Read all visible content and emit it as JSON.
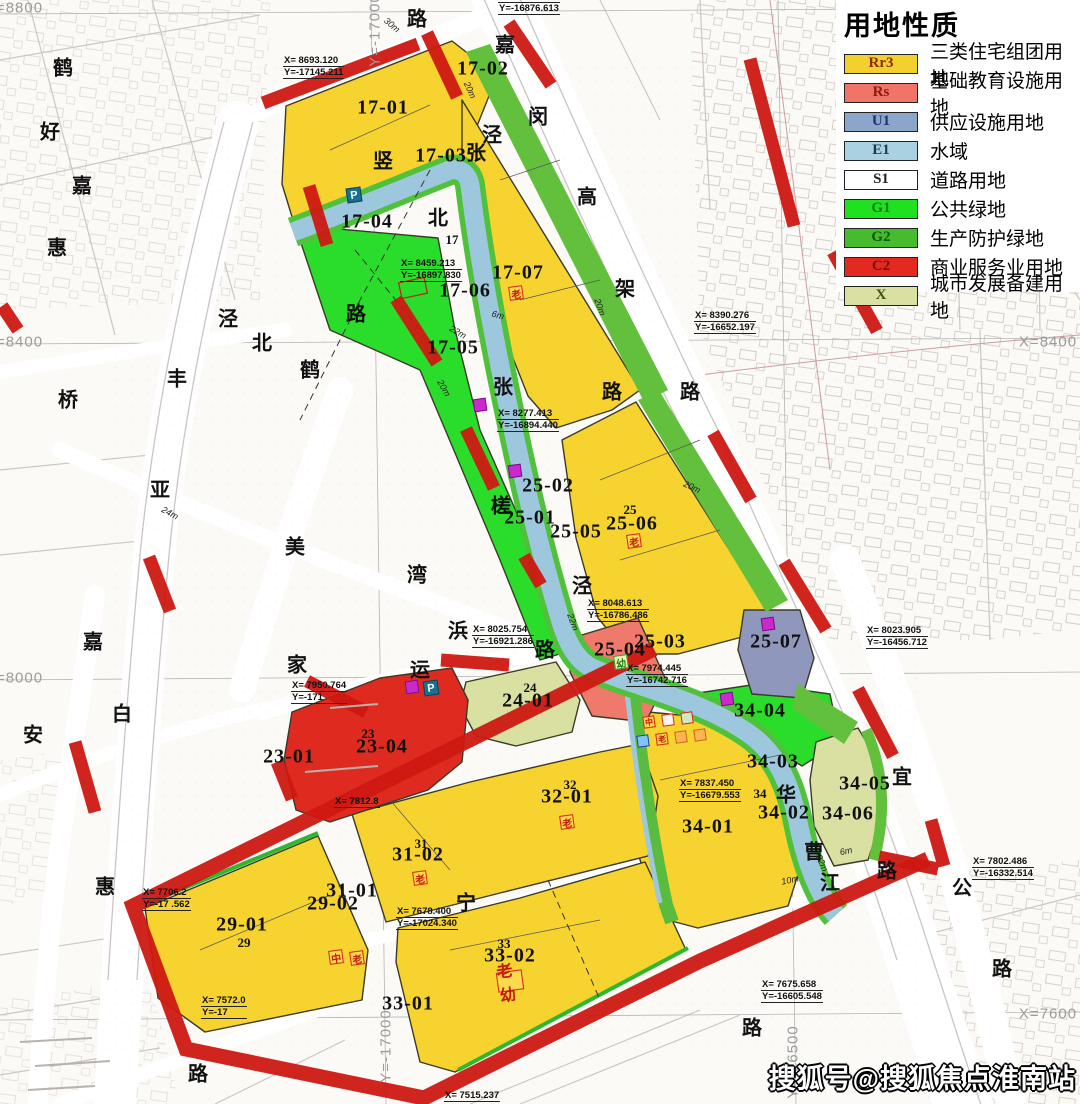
{
  "page": {
    "width": 1080,
    "height": 1104
  },
  "legend": {
    "title": "用地性质",
    "items": [
      {
        "code": "Rr3",
        "label": "三类住宅组团用地",
        "color": "#F2D12E",
        "code_color": "#8a2a00"
      },
      {
        "code": "Rs",
        "label": "基础教育设施用地",
        "color": "#F07467",
        "code_color": "#8b1a10"
      },
      {
        "code": "U1",
        "label": "供应设施用地",
        "color": "#8CA6CB",
        "code_color": "#20306b"
      },
      {
        "code": "E1",
        "label": "水域",
        "color": "#A9D1E2",
        "code_color": "#1a3a4a"
      },
      {
        "code": "S1",
        "label": "道路用地",
        "color": "#FFFFFF",
        "code_color": "#222222"
      },
      {
        "code": "G1",
        "label": "公共绿地",
        "color": "#1FE11F",
        "code_color": "#0a7a0a"
      },
      {
        "code": "G2",
        "label": "生产防护绿地",
        "color": "#45BB2D",
        "code_color": "#0b5a0b"
      },
      {
        "code": "C2",
        "label": "商业服务业用地",
        "color": "#E42A20",
        "code_color": "#7a0d08"
      },
      {
        "code": "X",
        "label": "城市发展备建用地",
        "color": "#D9E0A2",
        "code_color": "#3f5210"
      }
    ]
  },
  "watermark": {
    "text": "搜狐号@搜狐焦点淮南站"
  },
  "colors": {
    "residential_yellow": "#F6D32F",
    "education_salmon": "#EF796B",
    "utility_blue": "#9097BC",
    "water_blue": "#9CC7DD",
    "green_public": "#2ADD2A",
    "green_buffer": "#63C03C",
    "commercial_red": "#DF2B1F",
    "reserve_green": "#D9E0A2",
    "road_red": "#CE1812"
  },
  "map": {
    "parcel_labels": [
      {
        "t": "17-01",
        "x": 383,
        "y": 108
      },
      {
        "t": "17-02",
        "x": 483,
        "y": 69
      },
      {
        "t": "17-03",
        "x": 441,
        "y": 156
      },
      {
        "t": "17-04",
        "x": 367,
        "y": 222
      },
      {
        "t": "17-05",
        "x": 453,
        "y": 348
      },
      {
        "t": "17-06",
        "x": 465,
        "y": 291
      },
      {
        "t": "17-07",
        "x": 518,
        "y": 273
      },
      {
        "t": "25-01",
        "x": 530,
        "y": 518
      },
      {
        "t": "25-02",
        "x": 548,
        "y": 486
      },
      {
        "t": "25-05",
        "x": 576,
        "y": 532
      },
      {
        "t": "25-06",
        "x": 632,
        "y": 524
      },
      {
        "t": "25-03",
        "x": 660,
        "y": 642
      },
      {
        "t": "25-04",
        "x": 620,
        "y": 650
      },
      {
        "t": "25-07",
        "x": 776,
        "y": 642
      },
      {
        "t": "24-01",
        "x": 528,
        "y": 701
      },
      {
        "t": "23-04",
        "x": 382,
        "y": 747
      },
      {
        "t": "23-01",
        "x": 289,
        "y": 757
      },
      {
        "t": "29-01",
        "x": 242,
        "y": 925
      },
      {
        "t": "29-02",
        "x": 333,
        "y": 904
      },
      {
        "t": "31-01",
        "x": 352,
        "y": 891
      },
      {
        "t": "31-02",
        "x": 418,
        "y": 855
      },
      {
        "t": "32-01",
        "x": 567,
        "y": 797
      },
      {
        "t": "33-01",
        "x": 408,
        "y": 1004
      },
      {
        "t": "33-02",
        "x": 510,
        "y": 956
      },
      {
        "t": "34-01",
        "x": 708,
        "y": 827
      },
      {
        "t": "34-02",
        "x": 784,
        "y": 813
      },
      {
        "t": "34-03",
        "x": 773,
        "y": 762
      },
      {
        "t": "34-04",
        "x": 760,
        "y": 711
      },
      {
        "t": "34-05",
        "x": 865,
        "y": 784
      },
      {
        "t": "34-06",
        "x": 848,
        "y": 814
      }
    ],
    "sub_labels": [
      {
        "t": "17",
        "x": 452,
        "y": 240
      },
      {
        "t": "25",
        "x": 630,
        "y": 510
      },
      {
        "t": "23",
        "x": 368,
        "y": 734
      },
      {
        "t": "24",
        "x": 530,
        "y": 688
      },
      {
        "t": "29",
        "x": 244,
        "y": 943
      },
      {
        "t": "31",
        "x": 421,
        "y": 844
      },
      {
        "t": "32",
        "x": 570,
        "y": 785
      },
      {
        "t": "33",
        "x": 504,
        "y": 944
      },
      {
        "t": "34",
        "x": 760,
        "y": 794
      }
    ],
    "road_chars": [
      {
        "t": "鹤",
        "x": 63,
        "y": 66
      },
      {
        "t": "好",
        "x": 50,
        "y": 130
      },
      {
        "t": "嘉",
        "x": 82,
        "y": 184
      },
      {
        "t": "惠",
        "x": 57,
        "y": 246
      },
      {
        "t": "泾",
        "x": 228,
        "y": 317
      },
      {
        "t": "北",
        "x": 262,
        "y": 341
      },
      {
        "t": "丰",
        "x": 177,
        "y": 377
      },
      {
        "t": "桥",
        "x": 68,
        "y": 398
      },
      {
        "t": "亚",
        "x": 160,
        "y": 488
      },
      {
        "t": "美",
        "x": 295,
        "y": 545
      },
      {
        "t": "湾",
        "x": 417,
        "y": 573
      },
      {
        "t": "嘉",
        "x": 93,
        "y": 640
      },
      {
        "t": "白",
        "x": 122,
        "y": 712
      },
      {
        "t": "安",
        "x": 33,
        "y": 733
      },
      {
        "t": "惠",
        "x": 105,
        "y": 885
      },
      {
        "t": "路",
        "x": 198,
        "y": 1072
      },
      {
        "t": "路",
        "x": 356,
        "y": 312
      },
      {
        "t": "鹤",
        "x": 310,
        "y": 368
      },
      {
        "t": "北",
        "x": 438,
        "y": 216
      },
      {
        "t": "竖",
        "x": 383,
        "y": 159
      },
      {
        "t": "张",
        "x": 476,
        "y": 151
      },
      {
        "t": "泾",
        "x": 492,
        "y": 133
      },
      {
        "t": "张",
        "x": 503,
        "y": 385
      },
      {
        "t": "泾",
        "x": 582,
        "y": 584
      },
      {
        "t": "槎",
        "x": 501,
        "y": 504
      },
      {
        "t": "浜",
        "x": 458,
        "y": 629
      },
      {
        "t": "家",
        "x": 297,
        "y": 663
      },
      {
        "t": "运",
        "x": 420,
        "y": 668
      },
      {
        "t": "路",
        "x": 545,
        "y": 648
      },
      {
        "t": "宁",
        "x": 466,
        "y": 901
      },
      {
        "t": "嘉",
        "x": 505,
        "y": 43
      },
      {
        "t": "闵",
        "x": 538,
        "y": 115
      },
      {
        "t": "高",
        "x": 587,
        "y": 195
      },
      {
        "t": "架",
        "x": 625,
        "y": 287
      },
      {
        "t": "路",
        "x": 690,
        "y": 390
      },
      {
        "t": "路",
        "x": 612,
        "y": 390
      },
      {
        "t": "路",
        "x": 417,
        "y": 17
      },
      {
        "t": "宜",
        "x": 902,
        "y": 775
      },
      {
        "t": "公",
        "x": 962,
        "y": 886
      },
      {
        "t": "路",
        "x": 1002,
        "y": 967
      },
      {
        "t": "路",
        "x": 887,
        "y": 869
      },
      {
        "t": "路",
        "x": 752,
        "y": 1026
      },
      {
        "t": "曹",
        "x": 814,
        "y": 850
      },
      {
        "t": "江",
        "x": 830,
        "y": 881
      },
      {
        "t": "华",
        "x": 786,
        "y": 793
      }
    ],
    "dim_labels": [
      {
        "t": "30m",
        "x": 392,
        "y": 25,
        "r": 40
      },
      {
        "t": "20m",
        "x": 470,
        "y": 90,
        "r": 65
      },
      {
        "t": "6m",
        "x": 498,
        "y": 315,
        "r": 15
      },
      {
        "t": "22m",
        "x": 458,
        "y": 332,
        "r": 30
      },
      {
        "t": "20m",
        "x": 444,
        "y": 388,
        "r": 60
      },
      {
        "t": "20m",
        "x": 600,
        "y": 307,
        "r": 70
      },
      {
        "t": "24m",
        "x": 170,
        "y": 513,
        "r": 28
      },
      {
        "t": "20m",
        "x": 692,
        "y": 487,
        "r": 25
      },
      {
        "t": "22m",
        "x": 573,
        "y": 622,
        "r": 70
      },
      {
        "t": "10m",
        "x": 790,
        "y": 880,
        "r": -12
      },
      {
        "t": "22m",
        "x": 822,
        "y": 863,
        "r": 65
      },
      {
        "t": "6m",
        "x": 846,
        "y": 851,
        "r": -12
      }
    ],
    "grid_labels": [
      {
        "t": "X=8800",
        "x": 14,
        "y": 8,
        "r": 0
      },
      {
        "t": "X=8400",
        "x": 14,
        "y": 342,
        "r": 0
      },
      {
        "t": "X=8000",
        "x": 14,
        "y": 678,
        "r": 0
      },
      {
        "t": "X=8400",
        "x": 1048,
        "y": 342,
        "r": 0
      },
      {
        "t": "X=7600",
        "x": 1048,
        "y": 1014,
        "r": 0
      },
      {
        "t": "Y=-17000",
        "x": 375,
        "y": 30,
        "r": -90
      },
      {
        "t": "Y=-17000",
        "x": 386,
        "y": 1046,
        "r": -90
      },
      {
        "t": "Y=-16500",
        "x": 793,
        "y": 1062,
        "r": -90
      }
    ],
    "callouts": [
      {
        "xl": "X= 8693.120",
        "yl": "Y=-17145.211",
        "x": 283,
        "y": 55
      },
      {
        "xl": "X= 8604.073",
        "yl": "Y=-16876.613",
        "x": 498,
        "y": -9
      },
      {
        "xl": "X= 8459.213",
        "yl": "Y=-16897.830",
        "x": 400,
        "y": 258
      },
      {
        "xl": "X= 8390.276",
        "yl": "Y=-16652.197",
        "x": 694,
        "y": 310
      },
      {
        "xl": "X= 8277.413",
        "yl": "Y=-16894.440",
        "x": 497,
        "y": 408
      },
      {
        "xl": "X= 8048.613",
        "yl": "Y=-16786.486",
        "x": 587,
        "y": 598
      },
      {
        "xl": "X= 8025.754",
        "yl": "Y=-16921.286",
        "x": 472,
        "y": 624
      },
      {
        "xl": "X= 7974.445",
        "yl": "Y=-16742.716",
        "x": 626,
        "y": 663
      },
      {
        "xl": "X= 8023.905",
        "yl": "Y=-16456.712",
        "x": 866,
        "y": 625
      },
      {
        "xl": "X= 7950.764",
        "yl": "Y=-171",
        "x": 291,
        "y": 680
      },
      {
        "xl": "X= 7837.450",
        "yl": "Y=-16679.553",
        "x": 679,
        "y": 778
      },
      {
        "xl": "X= 7812.8",
        "yl": "",
        "x": 334,
        "y": 796
      },
      {
        "xl": "X= 7678.400",
        "yl": "Y=-17024.340",
        "x": 396,
        "y": 906
      },
      {
        "xl": "X= 7706.2",
        "yl": "Y=-17  .562",
        "x": 142,
        "y": 887
      },
      {
        "xl": "X= 7675.658",
        "yl": "Y=-16605.548",
        "x": 761,
        "y": 979
      },
      {
        "xl": "X= 7802.486",
        "yl": "Y=-16332.514",
        "x": 972,
        "y": 856
      },
      {
        "xl": "X= 7572.0",
        "yl": "Y=-17",
        "x": 201,
        "y": 995
      },
      {
        "xl": "X= 7515.237",
        "yl": "",
        "x": 444,
        "y": 1090
      }
    ],
    "icons": [
      {
        "k": "parking-icon",
        "g": "P",
        "x": 354,
        "y": 195,
        "bg": "#17708e",
        "bd": "#0d4257",
        "fg": "#fff",
        "w": 15
      },
      {
        "k": "parking-icon",
        "g": "P",
        "x": 431,
        "y": 688,
        "bg": "#17708e",
        "bd": "#0d4257",
        "fg": "#fff",
        "w": 15
      },
      {
        "k": "utility-icon",
        "g": "",
        "x": 480,
        "y": 405,
        "bg": "#cc29cc",
        "bd": "#7a0e8a",
        "fg": "#fff",
        "w": 13
      },
      {
        "k": "utility-icon",
        "g": "",
        "x": 515,
        "y": 471,
        "bg": "#cc29cc",
        "bd": "#7a0e8a",
        "fg": "#fff",
        "w": 13
      },
      {
        "k": "utility-icon",
        "g": "",
        "x": 412,
        "y": 687,
        "bg": "#cc29cc",
        "bd": "#7a0e8a",
        "fg": "#fff",
        "w": 13
      },
      {
        "k": "utility-icon",
        "g": "",
        "x": 768,
        "y": 624,
        "bg": "#cc29cc",
        "bd": "#7a0e8a",
        "fg": "#fff",
        "w": 13
      },
      {
        "k": "utility-icon",
        "g": "",
        "x": 727,
        "y": 699,
        "bg": "#cc29cc",
        "bd": "#7a0e8a",
        "fg": "#fff",
        "w": 13
      },
      {
        "k": "elder-icon",
        "g": "老",
        "x": 516,
        "y": 293,
        "bg": "#ffd94d",
        "bd": "#d42313",
        "fg": "#c41808",
        "w": 14
      },
      {
        "k": "elder-icon",
        "g": "老",
        "x": 634,
        "y": 541,
        "bg": "#ffd94d",
        "bd": "#d42313",
        "fg": "#c41808",
        "w": 14
      },
      {
        "k": "elder-icon",
        "g": "老",
        "x": 567,
        "y": 822,
        "bg": "#ffd94d",
        "bd": "#d42313",
        "fg": "#c41808",
        "w": 14
      },
      {
        "k": "elder-icon",
        "g": "老",
        "x": 420,
        "y": 878,
        "bg": "#ffd94d",
        "bd": "#d42313",
        "fg": "#c41808",
        "w": 14
      },
      {
        "k": "elder-icon",
        "g": "老",
        "x": 357,
        "y": 958,
        "bg": "#ffd94d",
        "bd": "#d42313",
        "fg": "#c41808",
        "w": 14
      },
      {
        "k": "middle-school-icon",
        "g": "中",
        "x": 336,
        "y": 957,
        "bg": "#ffd94d",
        "bd": "#d42313",
        "fg": "#c41808",
        "w": 14
      },
      {
        "k": "kindergarten-icon",
        "g": "幼",
        "x": 621,
        "y": 662,
        "bg": "#eef7b0",
        "bd": "#2a9a2a",
        "fg": "#157a15",
        "w": 14
      },
      {
        "k": "elder-kindergarten-icon",
        "g": "老幼",
        "x": 510,
        "y": 981,
        "bg": "#ffd94d",
        "bd": "#d42313",
        "fg": "#c41808",
        "w": 20
      },
      {
        "k": "facility-icon",
        "g": "中",
        "x": 649,
        "y": 722,
        "bg": "#ffd24d",
        "bd": "#d42313",
        "fg": "#c41808",
        "w": 12
      },
      {
        "k": "facility-icon",
        "g": "",
        "x": 668,
        "y": 720,
        "bg": "#fff4f0",
        "bd": "#d42313",
        "fg": "#c41808",
        "w": 12
      },
      {
        "k": "facility-icon",
        "g": "",
        "x": 687,
        "y": 718,
        "bg": "#cfe8c0",
        "bd": "#d42313",
        "fg": "#c41808",
        "w": 12
      },
      {
        "k": "facility-icon",
        "g": "",
        "x": 643,
        "y": 741,
        "bg": "#7fc4ff",
        "bd": "#23408a",
        "fg": "#fff",
        "w": 12
      },
      {
        "k": "facility-icon",
        "g": "老",
        "x": 662,
        "y": 739,
        "bg": "#ffd24d",
        "bd": "#d42313",
        "fg": "#c41808",
        "w": 12
      },
      {
        "k": "facility-icon",
        "g": "",
        "x": 681,
        "y": 737,
        "bg": "#ffb454",
        "bd": "#c86a10",
        "fg": "#fff",
        "w": 12
      },
      {
        "k": "facility-icon",
        "g": "",
        "x": 700,
        "y": 735,
        "bg": "#ffb454",
        "bd": "#c86a10",
        "fg": "#fff",
        "w": 12
      }
    ]
  }
}
